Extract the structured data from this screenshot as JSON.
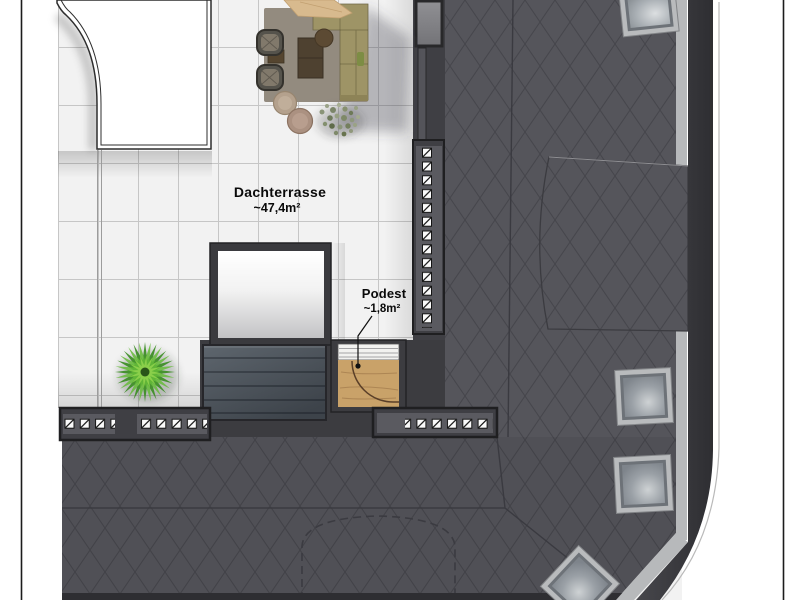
{
  "labels": {
    "terrace": {
      "title": "Dachterrasse",
      "area": "~47,4m²"
    },
    "podium": {
      "title": "Podest",
      "area": "~1,8m²"
    }
  },
  "palette": {
    "roof": "#55555b",
    "roof_lines": "#46464c",
    "roof_edge": "#35353a",
    "flashing": "#b7b9bb",
    "tile": "#f2f2f2",
    "grout": "#c6c6c6",
    "wood": "#c9a269",
    "slats": "#4b535b",
    "sofa": "#9e9466",
    "rug": "#8d8477",
    "plant": "#3f8f28",
    "text": "#0a0a0a"
  }
}
